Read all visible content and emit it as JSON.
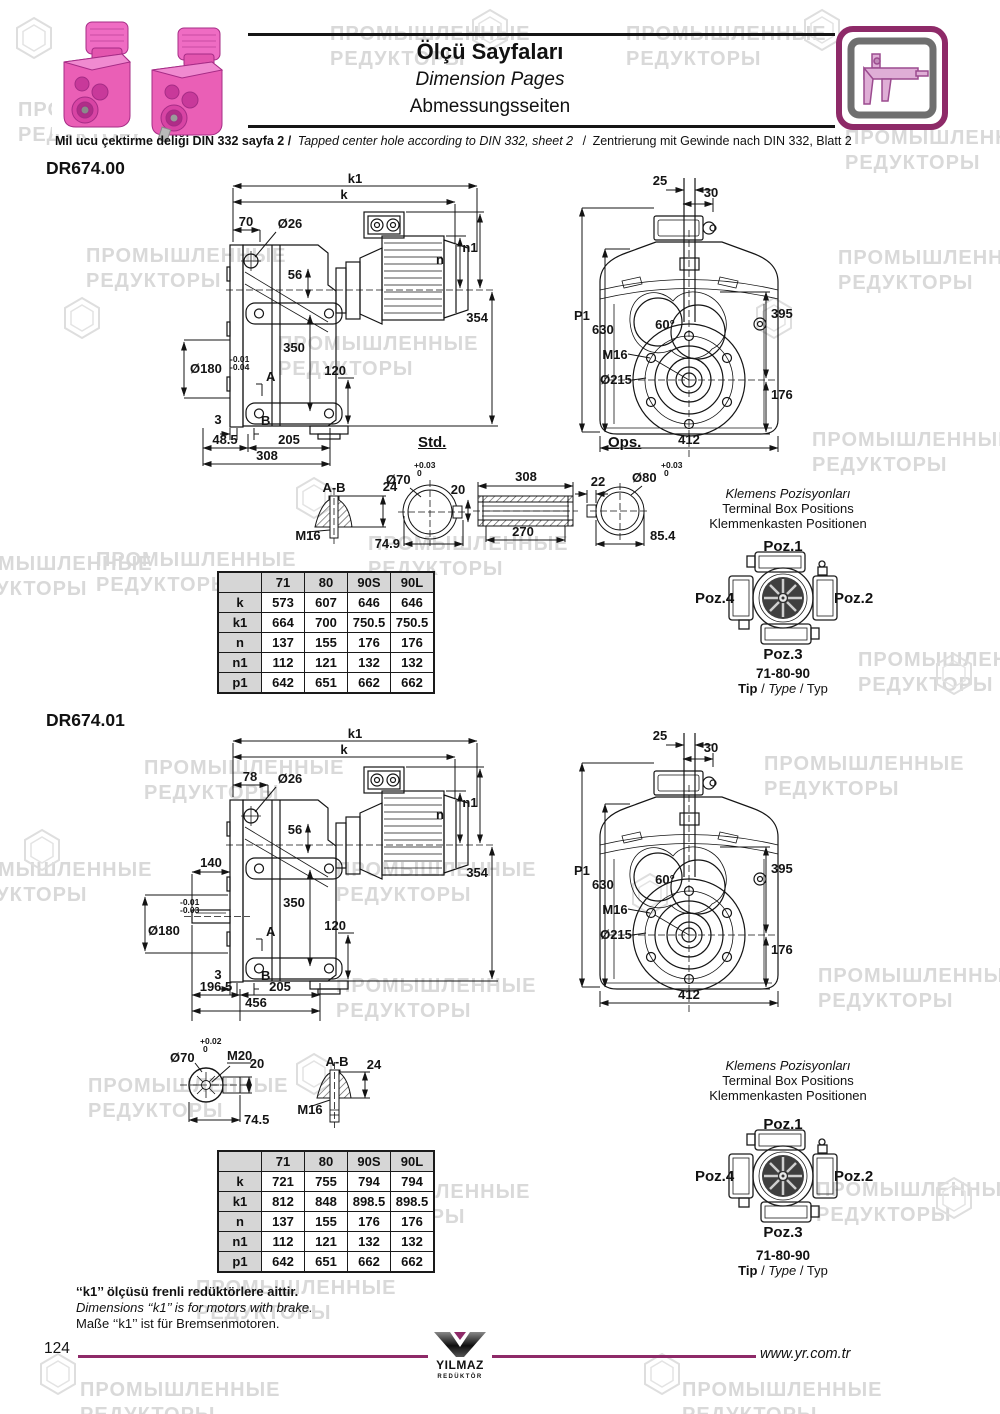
{
  "page": {
    "number": "124",
    "website": "www.yr.com.tr",
    "watermark": "ПРОМЫШЛЕННЫЕ\nРЕДУКТОРЫ",
    "accent_color": "#8e2a68"
  },
  "icons": {
    "watermark_logo": "hexagon-swirl",
    "header_badge": "caliper"
  },
  "header": {
    "title_tr": "Ölçü Sayfaları",
    "title_en": "Dimension Pages",
    "title_de": "Abmessungsseiten",
    "note_tr": "Mil ucu çektirme deliği DIN 332 sayfa 2 /",
    "note_en": "Tapped center hole according to DIN 332, sheet 2",
    "note_sep": "/",
    "note_de": "Zentrierung mit Gewinde nach DIN 332, Blatt 2"
  },
  "shared": {
    "std_label": "Std.",
    "ops_label": "Ops.",
    "front": {
      "d25": "25",
      "d30": "30",
      "p1": "P1",
      "d630": "630",
      "angle": "60°",
      "m16": "M16",
      "d215": "Ø215",
      "d395": "395",
      "d176": "176",
      "d412": "412"
    },
    "terminal": {
      "title_tr": "Klemens Pozisyonları",
      "title_en": "Terminal Box Positions",
      "title_de": "Klemmenkasten Positionen",
      "poz1": "Poz.1",
      "poz2": "Poz.2",
      "poz3": "Poz.3",
      "poz4": "Poz.4",
      "sizes": "71-80-90",
      "tip_tr": "Tip",
      "tip_en": "Type",
      "tip_de": "Typ",
      "tip_sep": "/"
    }
  },
  "sections": [
    {
      "model": "DR674.00",
      "side": {
        "k1": "k1",
        "k": "k",
        "d70": "70",
        "d26": "Ø26",
        "d56": "56",
        "n1": "n1",
        "n": "n",
        "d354": "354",
        "d350": "350",
        "d180": "Ø180",
        "tol_up": "-0.01",
        "tol_lo": "-0.04",
        "a": "A",
        "b": "B",
        "d120": "120",
        "d3": "3",
        "dim_a": "48.5",
        "dim_b": "205",
        "dim_c": "308"
      },
      "details": {
        "ab": "A-B",
        "ab24": "24",
        "abm16": "M16",
        "std_d": "Ø70",
        "std_tol_up": "+0.03",
        "std_tol_lo": "0",
        "std20": "20",
        "std_len": "74.9",
        "sleeve_top": "308",
        "sleeve_bot": "270",
        "ops22": "22",
        "ops_d": "Ø80",
        "ops_tol_up": "+0.03",
        "ops_tol_lo": "0",
        "ops_len": "85.4"
      },
      "table": {
        "headers": [
          "",
          "71",
          "80",
          "90S",
          "90L"
        ],
        "rows": [
          [
            "k",
            "573",
            "607",
            "646",
            "646"
          ],
          [
            "k1",
            "664",
            "700",
            "750.5",
            "750.5"
          ],
          [
            "n",
            "137",
            "155",
            "176",
            "176"
          ],
          [
            "n1",
            "112",
            "121",
            "132",
            "132"
          ],
          [
            "p1",
            "642",
            "651",
            "662",
            "662"
          ]
        ]
      }
    },
    {
      "model": "DR674.01",
      "side": {
        "k1": "k1",
        "k": "k",
        "d78": "78",
        "d26": "Ø26",
        "d56": "56",
        "n1": "n1",
        "n": "n",
        "d140": "140",
        "d354": "354",
        "d350": "350",
        "d180": "Ø180",
        "tol_up": "-0.01",
        "tol_lo": "-0.03",
        "a": "A",
        "b": "B",
        "d120": "120",
        "d3": "3",
        "dim_a": "196.5",
        "dim_b": "205",
        "dim_c": "456"
      },
      "details": {
        "shaft_d": "Ø70",
        "shaft_tol_up": "+0.02",
        "shaft_tol_lo": "0",
        "m20": "M20",
        "d20": "20",
        "len": "74.5",
        "ab": "A-B",
        "ab24": "24",
        "abm16": "M16"
      },
      "table": {
        "headers": [
          "",
          "71",
          "80",
          "90S",
          "90L"
        ],
        "rows": [
          [
            "k",
            "721",
            "755",
            "794",
            "794"
          ],
          [
            "k1",
            "812",
            "848",
            "898.5",
            "898.5"
          ],
          [
            "n",
            "137",
            "155",
            "176",
            "176"
          ],
          [
            "n1",
            "112",
            "121",
            "132",
            "132"
          ],
          [
            "p1",
            "642",
            "651",
            "662",
            "662"
          ]
        ]
      }
    }
  ],
  "footnote": {
    "tr": "‘‘k1’’ ölçüsü frenli redüktörlere aittir.",
    "en": "Dimensions ‘‘k1’’ is for motors with brake.",
    "de": "Maße ‘‘k1’’ ist für Bremsenmotoren."
  },
  "logo": {
    "name": "YILMAZ",
    "sub": "REDÜKTÖR"
  }
}
